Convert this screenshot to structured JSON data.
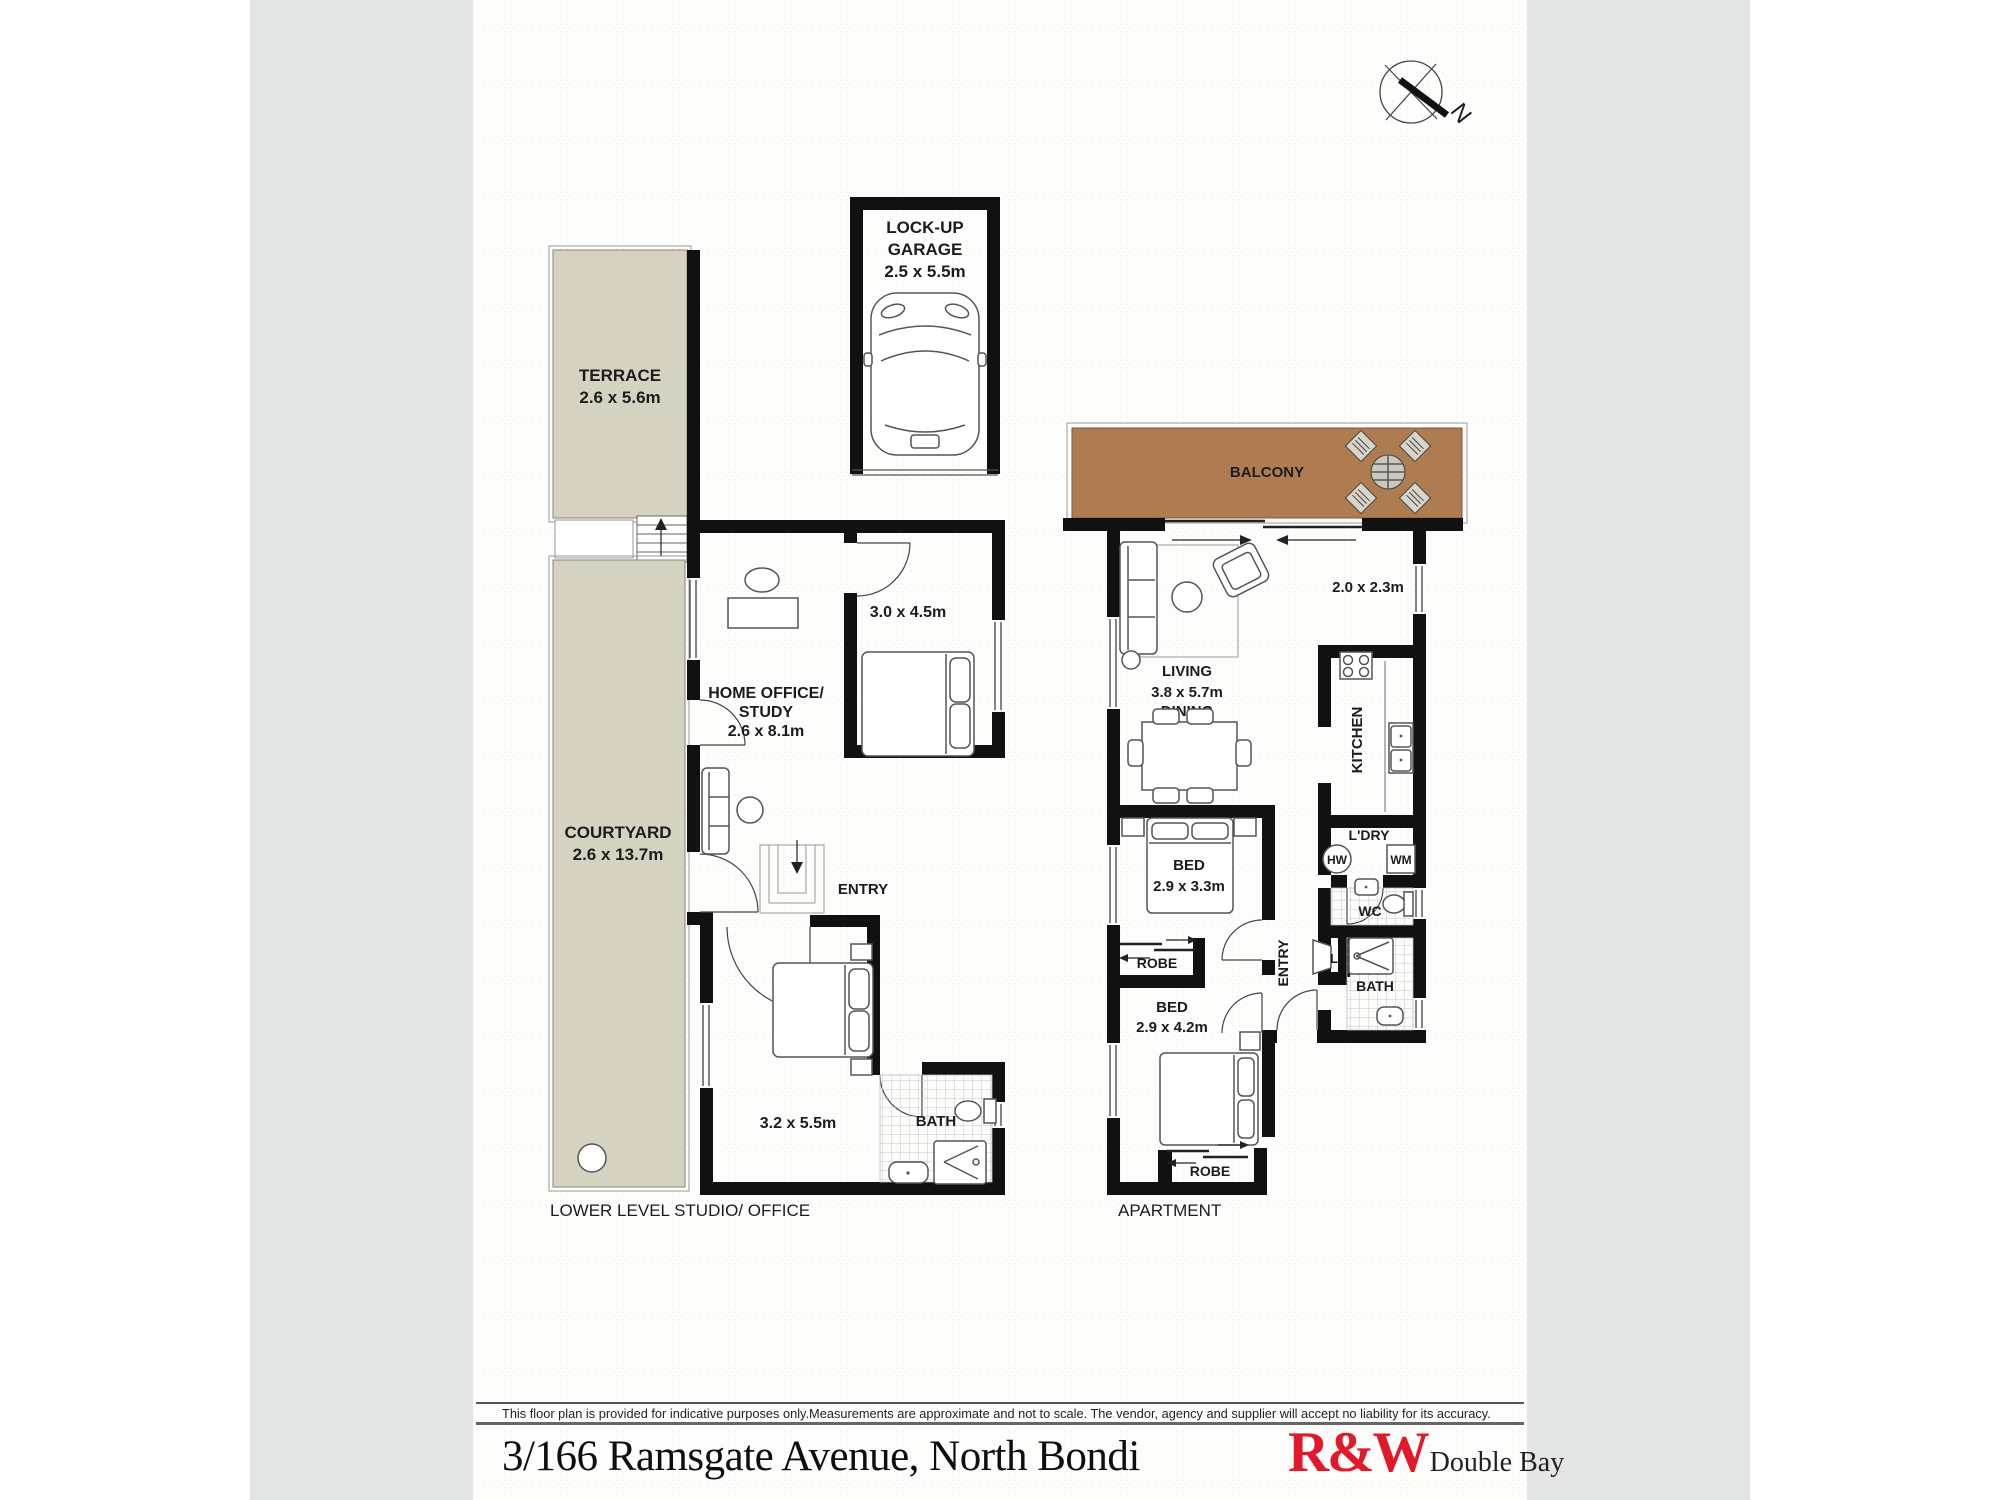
{
  "compass": {
    "north_label": "N"
  },
  "lower_level": {
    "caption": "LOWER LEVEL STUDIO/ OFFICE",
    "garage": {
      "line1": "LOCK-UP",
      "line2": "GARAGE",
      "dims": "2.5 x 5.5m"
    },
    "terrace": {
      "name": "TERRACE",
      "dims": "2.6 x 5.6m"
    },
    "courtyard": {
      "name": "COURTYARD",
      "dims": "2.6 x 13.7m"
    },
    "home_office": {
      "line1": "HOME OFFICE/",
      "line2": "STUDY",
      "dims": "2.6 x 8.1m"
    },
    "bedroom_upper": {
      "dims": "3.0 x 4.5m"
    },
    "entry": {
      "name": "ENTRY"
    },
    "bedroom_lower": {
      "dims": "3.2 x 5.5m"
    },
    "bath": {
      "name": "BATH"
    }
  },
  "apartment": {
    "caption": "APARTMENT",
    "balcony": {
      "name": "BALCONY"
    },
    "living_dining": {
      "line1": "LIVING",
      "dims": "3.8 x 5.7m",
      "line3": "DINING"
    },
    "nook": {
      "dims": "2.0 x 2.3m"
    },
    "kitchen": {
      "name": "KITCHEN"
    },
    "laundry": {
      "name": "L'DRY",
      "hot_water": "HW",
      "washing_machine": "WM"
    },
    "wc": {
      "name": "WC"
    },
    "linen": {
      "name": "L"
    },
    "bath": {
      "name": "BATH"
    },
    "entry": {
      "name": "ENTRY"
    },
    "bed1": {
      "name": "BED",
      "dims": "2.9 x 3.3m"
    },
    "robe1": {
      "name": "ROBE"
    },
    "bed2": {
      "name": "BED",
      "dims": "2.9 x 4.2m"
    },
    "robe2": {
      "name": "ROBE"
    }
  },
  "footer": {
    "disclaimer": "This floor plan is provided for indicative purposes only.Measurements are approximate and not to scale. The vendor, agency and supplier will accept no liability for its accuracy.",
    "address": "3/166 Ramsgate Avenue, North Bondi",
    "brand": "R&W",
    "office": "Double Bay"
  },
  "colors": {
    "outdoor_beige": "#d6d2c1",
    "balcony_brown": "#ae7c50",
    "wall_black": "#111111",
    "brand_red": "#e2182b",
    "mat_gray": "#e4e5e5"
  }
}
